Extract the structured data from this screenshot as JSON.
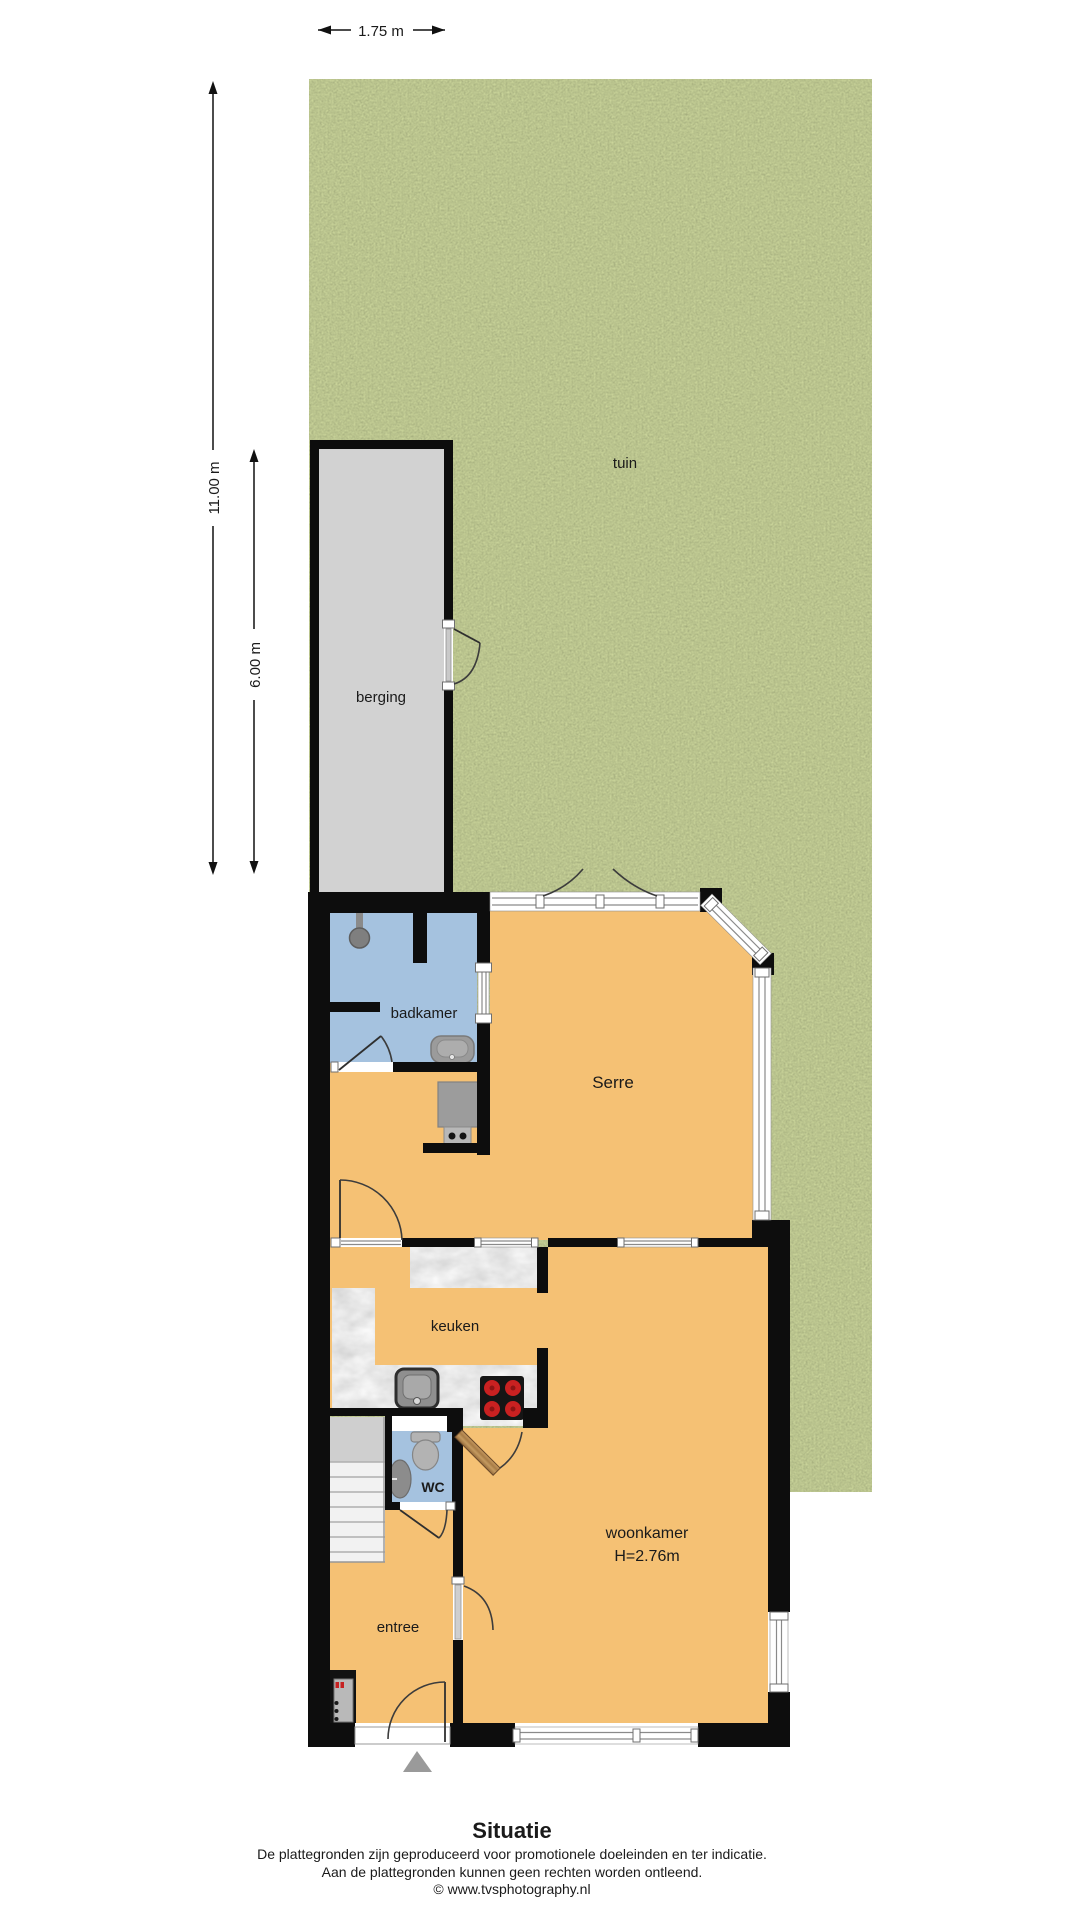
{
  "dimensions": {
    "top_width": "1.75 m",
    "left_total_depth": "11.00 m",
    "left_berging_depth": "6.00 m"
  },
  "rooms": {
    "tuin": "tuin",
    "berging": "berging",
    "badkamer": "badkamer",
    "serre": "Serre",
    "keuken": "keuken",
    "woonkamer": "woonkamer",
    "woonkamer_height": "H=2.76m",
    "wc": "WC",
    "entree": "entree"
  },
  "footer": {
    "title": "Situatie",
    "disclaimer_line1": "De plattegronden zijn geproduceerd voor promotionele doeleinden en ter indicatie.",
    "disclaimer_line2": "Aan de plattegronden kunnen geen rechten worden ontleend.",
    "credit": "© www.tvsphotography.nl"
  },
  "colors": {
    "floor_orange": "#F5C174",
    "wet_room_blue": "#A5C2DF",
    "berging_gray": "#D2D2D2",
    "wall_black": "#0D0D0D",
    "grass_green": "#7C8C44",
    "counter_gray": "#ABABAB",
    "stove_red": "#C92121"
  }
}
